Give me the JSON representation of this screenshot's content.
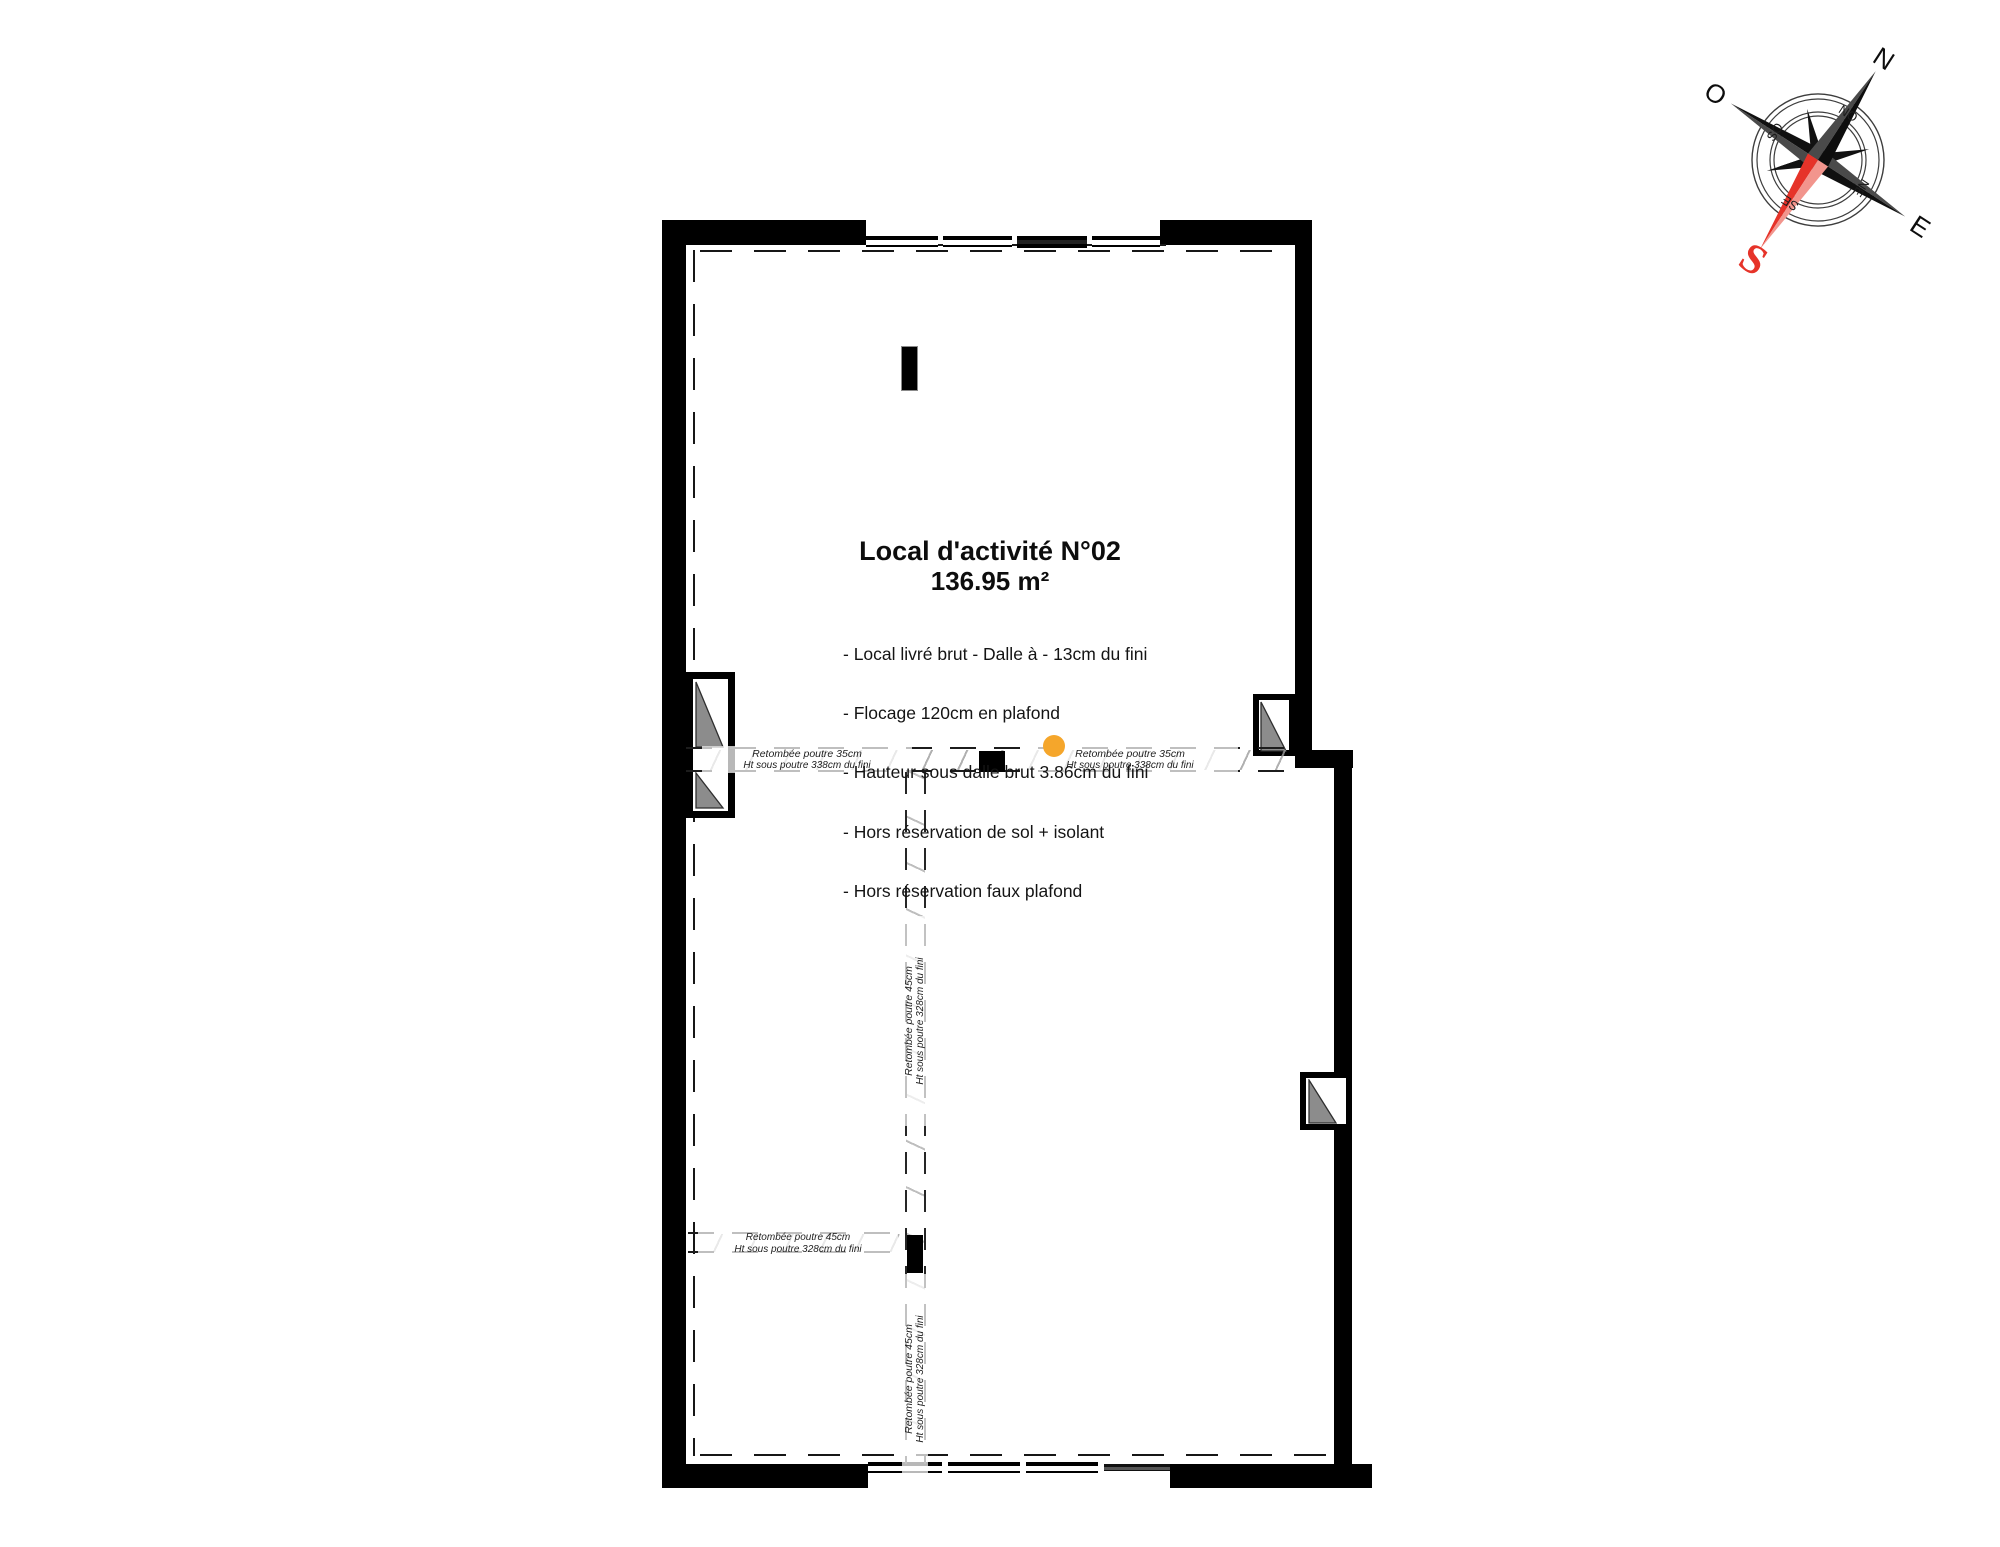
{
  "plan": {
    "title": "Local d'activité N°02",
    "area": "136.95 m²",
    "specs": [
      "- Local livré brut - Dalle à - 13cm du fini",
      "- Flocage 120cm en plafond",
      "- Hauteur sous dalle brut 3.86cm du fini",
      "- Hors réservation de sol + isolant",
      "- Hors réservation faux plafond"
    ]
  },
  "beam_labels": {
    "beam35": {
      "line1": "Retombée poutre 35cm",
      "line2": "Ht sous poutre 338cm du fini"
    },
    "beam45": {
      "line1": "Retombée poutre 45cm",
      "line2": "Ht sous poutre 328cm du fini"
    }
  },
  "compass": {
    "n": "N",
    "ne": "NE",
    "e": "E",
    "se": "SE",
    "s": "S",
    "so": "SO",
    "o": "O",
    "no": "NO"
  },
  "colors": {
    "wall": "#000000",
    "glass_triangle": "#8c8c8c",
    "beam_point_marker": "#f5a62b",
    "south_red": "#e63329",
    "hatch_gray": "#9d9d9d"
  }
}
